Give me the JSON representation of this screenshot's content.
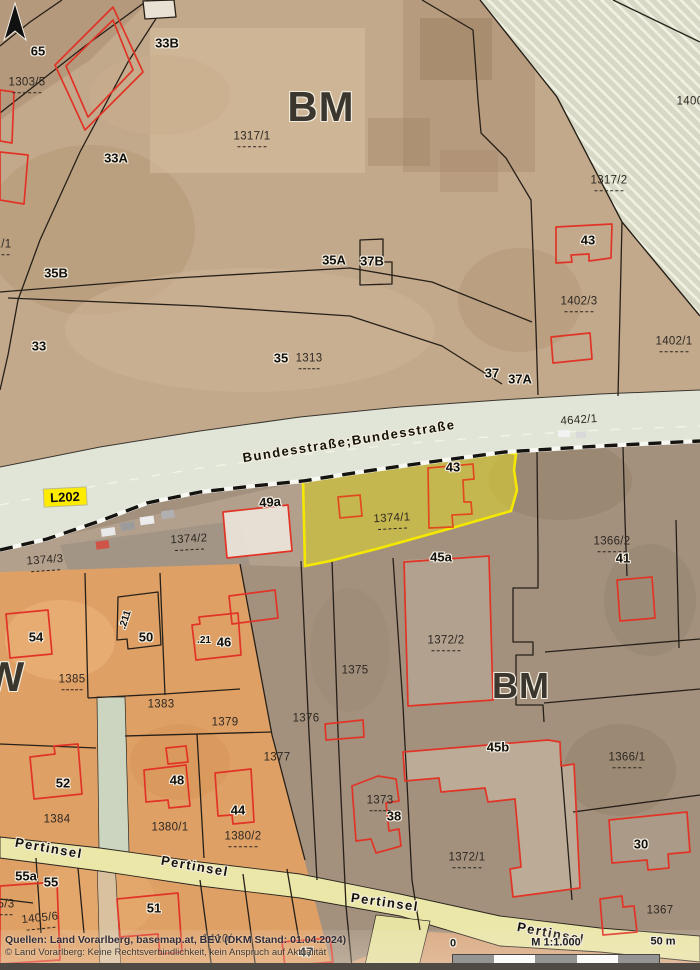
{
  "map": {
    "zone_letters": {
      "bm_top": "BM",
      "bm_mid": "BM",
      "w_left": "W"
    },
    "street_labels": {
      "bundesstrasse": "Bundesstraße;Bundesstraße",
      "l202": "L202",
      "pertinsel1": "Pertinsel",
      "pertinsel2": "Pertinsel",
      "pertinsel3": "Pertinsel",
      "pertinsel4": "Pertinsel"
    },
    "road_parcel": "4642/1",
    "house_numbers": {
      "n65": "65",
      "n33b": "33B",
      "n33a": "33A",
      "n35b": "35B",
      "n33": "33",
      "n35": "35",
      "n35a": "35A",
      "n37b": "37B",
      "n37": "37",
      "n37a": "37A",
      "n43_top": "43",
      "n43_hl": "43",
      "n49a": "49a",
      "n45a": "45a",
      "n41": "41",
      "n54": "54",
      "n50": "50",
      "n21": ".21",
      "n211": ".211",
      "n46": "46",
      "n52": "52",
      "n48": "48",
      "n44": "44",
      "n38": "38",
      "n45b": "45b",
      "n30": "30",
      "n55a": "55a",
      "n55": "55",
      "n51": "51",
      "n47": "47"
    },
    "parcel_numbers": {
      "p1303_5": "1303/5",
      "p1_1": "1/1",
      "p1317_1": "1317/1",
      "p1317_2": "1317/2",
      "p1400": "1400",
      "p1402_3": "1402/3",
      "p1402_1": "1402/1",
      "p1313": "1313",
      "p1374_1": "1374/1",
      "p1374_2": "1374/2",
      "p1374_3": "1374/3",
      "p1366_2": "1366/2",
      "p1385": "1385",
      "p1383": "1383",
      "p1379": "1379",
      "p1375": "1375",
      "p1376": "1376",
      "p1377": "1377",
      "p1372_2": "1372/2",
      "p1384": "1384",
      "p1380_1": "1380/1",
      "p1380_2": "1380/2",
      "p1373": "1373",
      "p1372_1": "1372/1",
      "p1366_1": "1366/1",
      "p1367": "1367",
      "p1405_6": "1405/6",
      "p5_3": "5/3",
      "p1410": "1410/"
    }
  },
  "highlight": {
    "parcel": "1374/1",
    "house": "43",
    "fill": "#e6da32",
    "border": "#f7e900"
  },
  "attribution": {
    "line1": "Quellen: Land Vorarlberg, basemap.at, BEV (DKM Stand: 01.04.2024)",
    "line2": "© Land Vorarlberg: Keine Rechtsverbindlichkeit, kein Anspruch auf Aktualität"
  },
  "scalebar": {
    "zero": "0",
    "ratio": "M 1:1.000",
    "distance": "50 m"
  },
  "colors": {
    "building_outline": "#e13426",
    "boundary": "#262019",
    "road_fill": "#e0e5d7",
    "pertinsel_fill": "#ebe7a8",
    "badge_bg": "#ffeb00",
    "hatch_base": "#d7d9c6"
  }
}
